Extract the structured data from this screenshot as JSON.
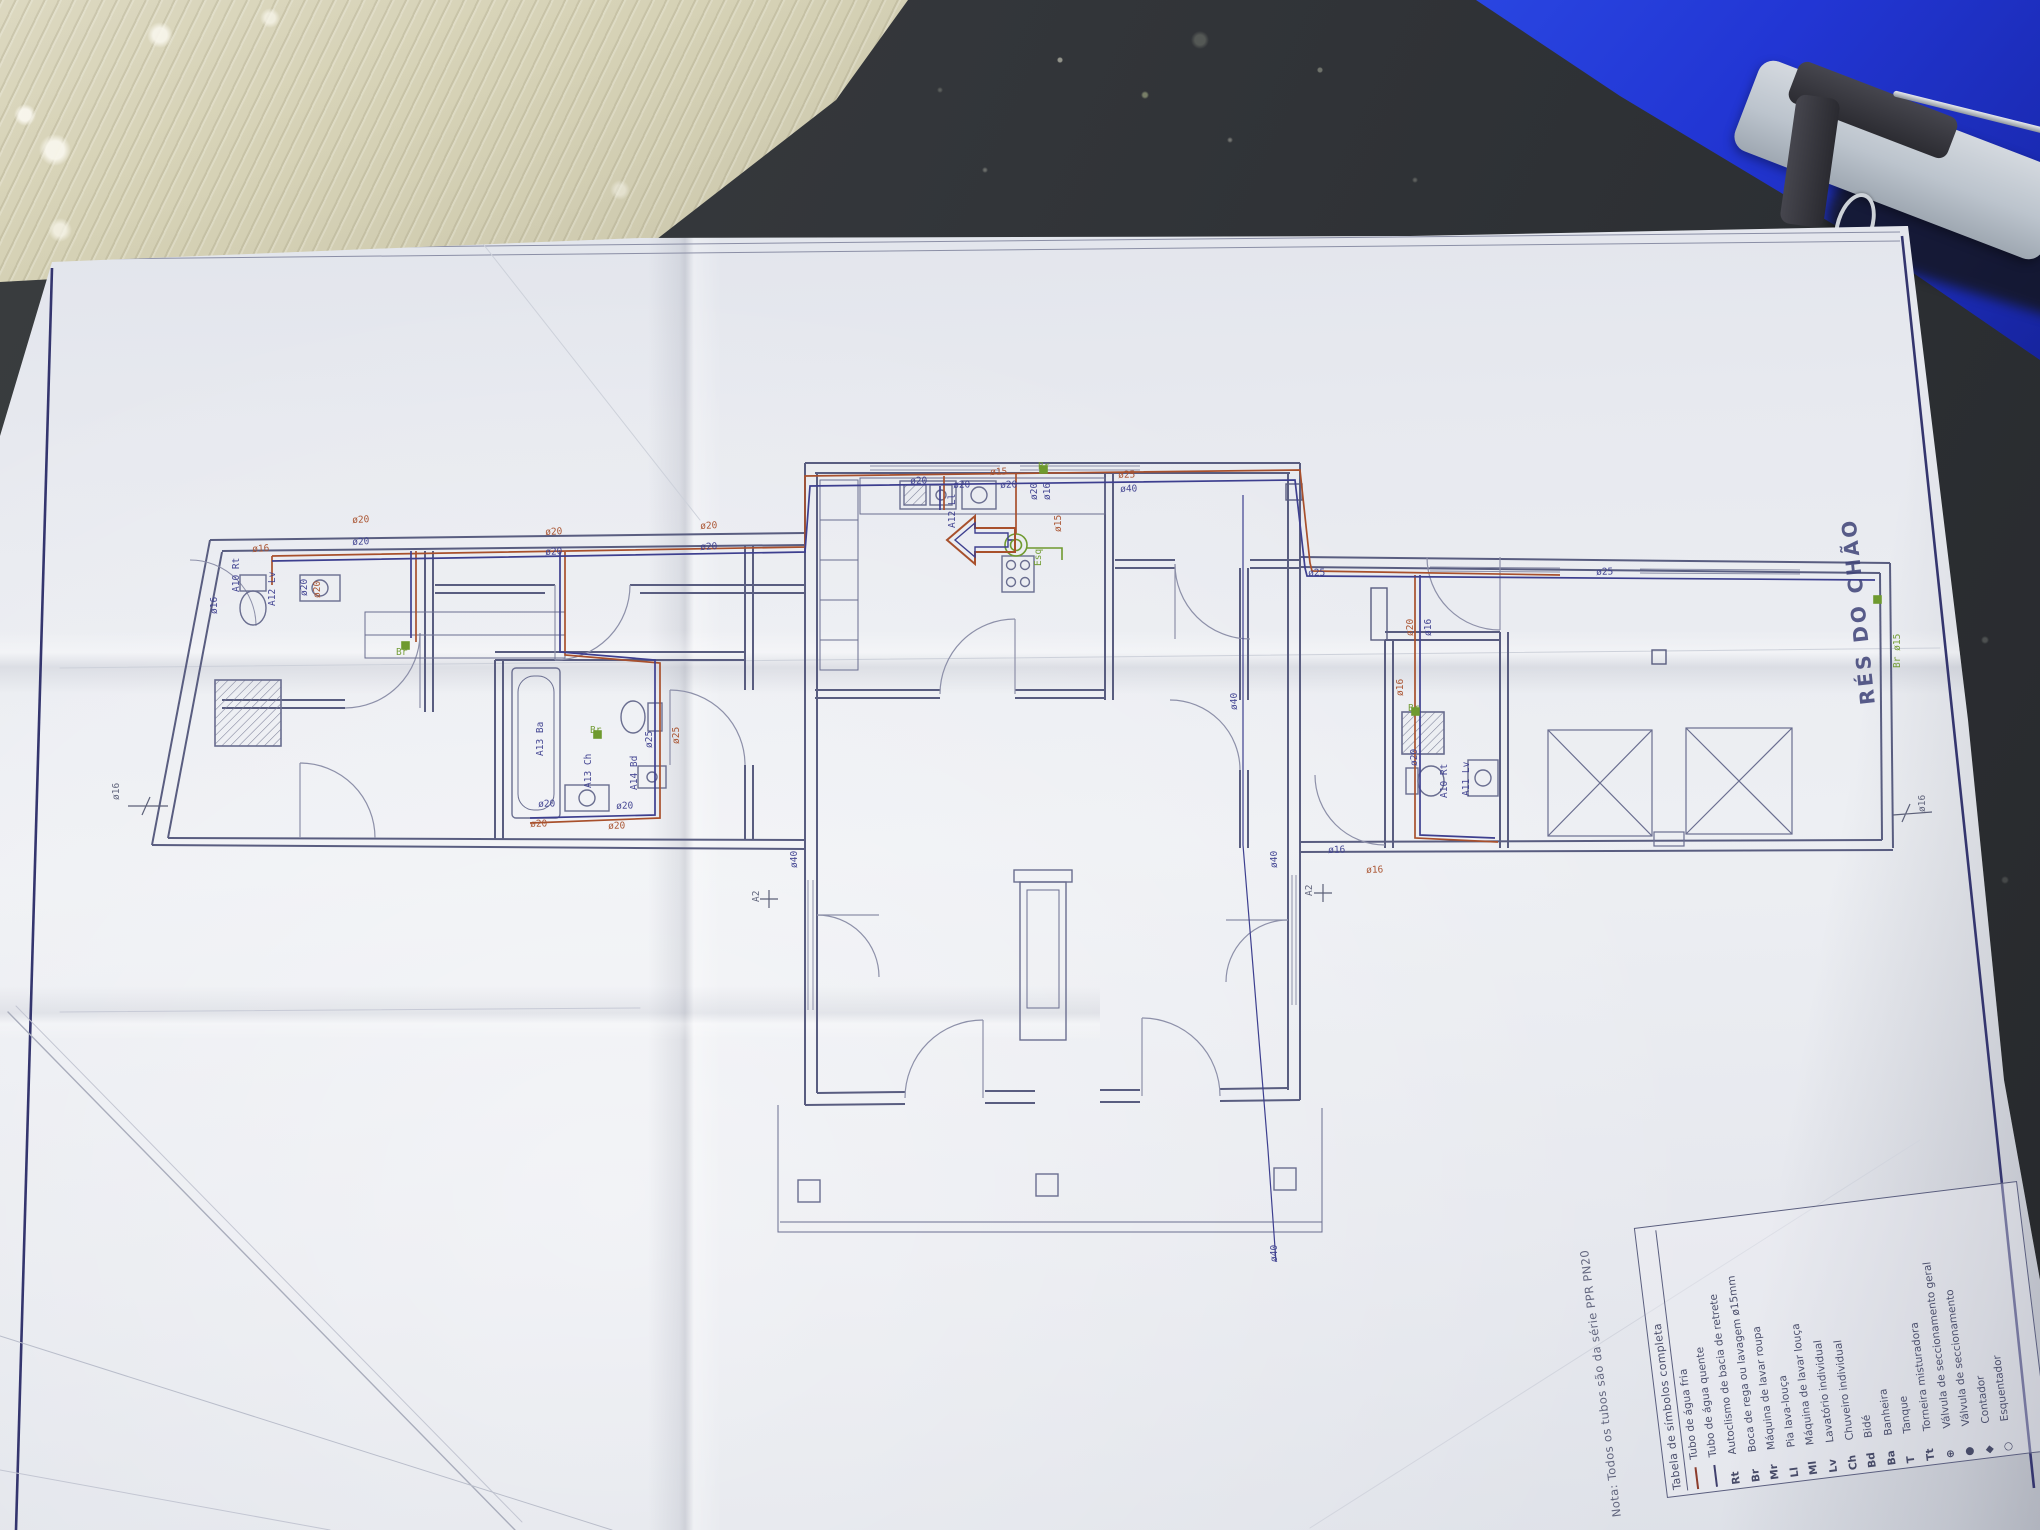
{
  "colors": {
    "pipe_cold": "#3d3f8f",
    "pipe_hot": "#a8502c",
    "accent_green": "#6f9a2f",
    "frame_navy": "#34356e",
    "folder_blue": "#2236d4"
  },
  "sheet": {
    "title_vertical": "RÉS DO CHÃO",
    "note": "Nota: Todos os tubos são da série PPR PN20",
    "legend": {
      "title": "Tabela de símbolos completa",
      "rows": [
        {
          "symbol": "line-red",
          "label": "Tubo de água fria"
        },
        {
          "symbol": "line-dark",
          "label": "Tubo de água quente"
        },
        {
          "symbol": "Rt",
          "label": "Autoclismo de bacia de retrete"
        },
        {
          "symbol": "Br",
          "label": "Boca de rega ou lavagem ø15mm"
        },
        {
          "symbol": "Mr",
          "label": "Máquina de lavar roupa"
        },
        {
          "symbol": "Ll",
          "label": "Pia lava-louça"
        },
        {
          "symbol": "Ml",
          "label": "Máquina de lavar louça"
        },
        {
          "symbol": "Lv",
          "label": "Lavatório individual"
        },
        {
          "symbol": "Ch",
          "label": "Chuveiro individual"
        },
        {
          "symbol": "Bd",
          "label": "Bidé"
        },
        {
          "symbol": "Ba",
          "label": "Banheira"
        },
        {
          "symbol": "T",
          "label": "Tanque"
        },
        {
          "symbol": "Tt",
          "label": "Torneira misturadora"
        },
        {
          "symbol": "⊕",
          "label": "Válvula de seccionamento geral"
        },
        {
          "symbol": "●",
          "label": "Válvula de seccionamento"
        },
        {
          "symbol": "◆",
          "label": "Contador"
        },
        {
          "symbol": "○",
          "label": "Esquentador"
        }
      ]
    },
    "plan_labels": [
      {
        "t": "ø20",
        "x": 352,
        "y": 516,
        "r": -3,
        "c": "o"
      },
      {
        "t": "ø20",
        "x": 352,
        "y": 538,
        "r": -3,
        "c": "b"
      },
      {
        "t": "ø16",
        "x": 252,
        "y": 545,
        "r": -3,
        "c": "o"
      },
      {
        "t": "ø20",
        "x": 300,
        "y": 596,
        "r": -90,
        "c": "b"
      },
      {
        "t": "ø20",
        "x": 313,
        "y": 598,
        "r": -90,
        "c": "o"
      },
      {
        "t": "A10 Rt",
        "x": 232,
        "y": 592,
        "r": -90,
        "c": "b"
      },
      {
        "t": "ø16",
        "x": 210,
        "y": 614,
        "r": -90,
        "c": "b"
      },
      {
        "t": "A12 Lv",
        "x": 268,
        "y": 606,
        "r": -90,
        "c": "b"
      },
      {
        "t": "Br",
        "x": 396,
        "y": 648,
        "r": 0,
        "c": "g"
      },
      {
        "t": "ø20",
        "x": 545,
        "y": 528,
        "r": -3,
        "c": "o"
      },
      {
        "t": "ø20",
        "x": 545,
        "y": 548,
        "r": -3,
        "c": "b"
      },
      {
        "t": "ø20",
        "x": 700,
        "y": 522,
        "r": -3,
        "c": "o"
      },
      {
        "t": "ø20",
        "x": 700,
        "y": 543,
        "r": -3,
        "c": "b"
      },
      {
        "t": "A13 Ba",
        "x": 536,
        "y": 756,
        "r": -90,
        "c": "b"
      },
      {
        "t": "A13 Ch",
        "x": 584,
        "y": 788,
        "r": -90,
        "c": "b"
      },
      {
        "t": "A14 Bd",
        "x": 630,
        "y": 790,
        "r": -90,
        "c": "b"
      },
      {
        "t": "ø25",
        "x": 645,
        "y": 748,
        "r": -90,
        "c": "b"
      },
      {
        "t": "ø25",
        "x": 672,
        "y": 744,
        "r": -90,
        "c": "o"
      },
      {
        "t": "ø20",
        "x": 538,
        "y": 800,
        "r": -2,
        "c": "b"
      },
      {
        "t": "ø20",
        "x": 616,
        "y": 802,
        "r": -2,
        "c": "b"
      },
      {
        "t": "ø20",
        "x": 530,
        "y": 820,
        "r": -2,
        "c": "o"
      },
      {
        "t": "ø20",
        "x": 608,
        "y": 822,
        "r": -2,
        "c": "o"
      },
      {
        "t": "Br",
        "x": 590,
        "y": 726,
        "r": 0,
        "c": "g"
      },
      {
        "t": "ø20",
        "x": 910,
        "y": 477,
        "r": -2,
        "c": "b"
      },
      {
        "t": "ø20",
        "x": 953,
        "y": 481,
        "r": -2,
        "c": "b"
      },
      {
        "t": "ø15",
        "x": 990,
        "y": 468,
        "r": -2,
        "c": "o"
      },
      {
        "t": "ø20",
        "x": 1000,
        "y": 481,
        "r": -2,
        "c": "b"
      },
      {
        "t": "A12 Ll",
        "x": 948,
        "y": 528,
        "r": -90,
        "c": "b"
      },
      {
        "t": "ø20",
        "x": 1030,
        "y": 500,
        "r": -90,
        "c": "b"
      },
      {
        "t": "ø16",
        "x": 1043,
        "y": 500,
        "r": -90,
        "c": "b"
      },
      {
        "t": "ø15",
        "x": 1054,
        "y": 532,
        "r": -90,
        "c": "o"
      },
      {
        "t": "Br",
        "x": 1038,
        "y": 462,
        "r": 0,
        "c": "g"
      },
      {
        "t": "Esq",
        "x": 1034,
        "y": 566,
        "r": -90,
        "c": "g"
      },
      {
        "t": "ø25",
        "x": 1118,
        "y": 471,
        "r": -2,
        "c": "o"
      },
      {
        "t": "ø40",
        "x": 1120,
        "y": 485,
        "r": -2,
        "c": "b"
      },
      {
        "t": "ø25",
        "x": 1308,
        "y": 569,
        "r": -2,
        "c": "b"
      },
      {
        "t": "ø40",
        "x": 1230,
        "y": 710,
        "r": -90,
        "c": "b"
      },
      {
        "t": "ø40",
        "x": 1270,
        "y": 868,
        "r": -90,
        "c": "b"
      },
      {
        "t": "ø40",
        "x": 1270,
        "y": 1262,
        "r": -90,
        "c": "b"
      },
      {
        "t": "ø40",
        "x": 790,
        "y": 868,
        "r": -90,
        "c": "b"
      },
      {
        "t": "A2",
        "x": 752,
        "y": 902,
        "r": -90,
        "c": "n"
      },
      {
        "t": "A2",
        "x": 1305,
        "y": 896,
        "r": -90,
        "c": "n"
      },
      {
        "t": "ø25",
        "x": 1596,
        "y": 568,
        "r": -2,
        "c": "b"
      },
      {
        "t": "ø20",
        "x": 1406,
        "y": 636,
        "r": -90,
        "c": "o"
      },
      {
        "t": "ø16",
        "x": 1424,
        "y": 636,
        "r": -90,
        "c": "b"
      },
      {
        "t": "ø16",
        "x": 1396,
        "y": 696,
        "r": -90,
        "c": "o"
      },
      {
        "t": "ø20",
        "x": 1410,
        "y": 766,
        "r": -90,
        "c": "b"
      },
      {
        "t": "A10 Rt",
        "x": 1440,
        "y": 798,
        "r": -90,
        "c": "b"
      },
      {
        "t": "A11 Lv",
        "x": 1462,
        "y": 796,
        "r": -90,
        "c": "b"
      },
      {
        "t": "ø16",
        "x": 1328,
        "y": 846,
        "r": -2,
        "c": "b"
      },
      {
        "t": "ø16",
        "x": 1366,
        "y": 866,
        "r": -2,
        "c": "o"
      },
      {
        "t": "Br",
        "x": 1408,
        "y": 704,
        "r": 0,
        "c": "g"
      },
      {
        "t": "Br ø15",
        "x": 1893,
        "y": 668,
        "r": -90,
        "c": "g"
      },
      {
        "t": "ø16",
        "x": 112,
        "y": 800,
        "r": -90,
        "c": "n"
      },
      {
        "t": "ø16",
        "x": 1918,
        "y": 812,
        "r": -90,
        "c": "n"
      }
    ]
  }
}
